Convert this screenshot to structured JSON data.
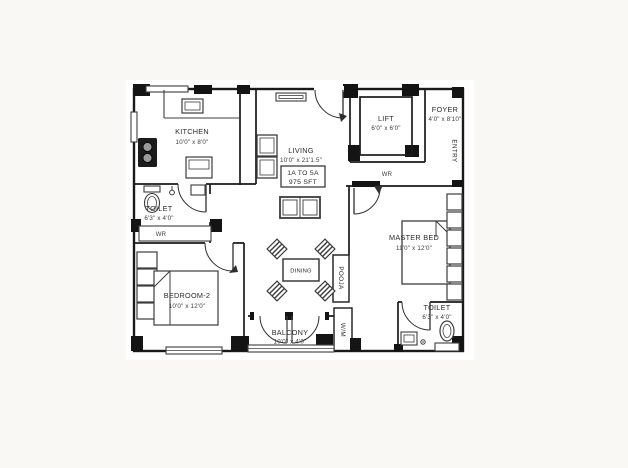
{
  "plan": {
    "unit_label": {
      "line1": "1A TO 5A",
      "line2": "975 SFT"
    },
    "rooms": {
      "kitchen": {
        "name": "KITCHEN",
        "dims": "10'0\" x 8'0\""
      },
      "toilet_left": {
        "name": "TOILET",
        "dims": "6'3\" x 4'0\""
      },
      "wr_left": {
        "name": "WR"
      },
      "bedroom2": {
        "name": "BEDROOM-2",
        "dims": "10'0\" x 12'0\""
      },
      "living": {
        "name": "LIVING",
        "dims": "10'0\" x 21'1.5\""
      },
      "dining": {
        "name": "DINING"
      },
      "balcony": {
        "name": "BALCONY",
        "dims": "10'0\" x 4'0\""
      },
      "washing_machine": {
        "name": "W/M"
      },
      "pooja": {
        "name": "POOJA"
      },
      "master_bed": {
        "name": "MASTER BED",
        "dims": "11'0\" x 12'0\""
      },
      "toilet_right": {
        "name": "TOILET",
        "dims": "6'3\" x 4'0\""
      },
      "lift": {
        "name": "LIFT",
        "dims": "6'0\" x 6'0\""
      },
      "wr_lift": {
        "name": "WR"
      },
      "foyer": {
        "name": "FOYER",
        "dims": "4'0\" x 8'10\""
      },
      "entry": {
        "name": "ENTRY"
      }
    },
    "colors": {
      "wall": "#1a1a1a",
      "paper": "#ffffff",
      "page_bg": "#faf8f5",
      "text": "#2b2b2b"
    }
  }
}
